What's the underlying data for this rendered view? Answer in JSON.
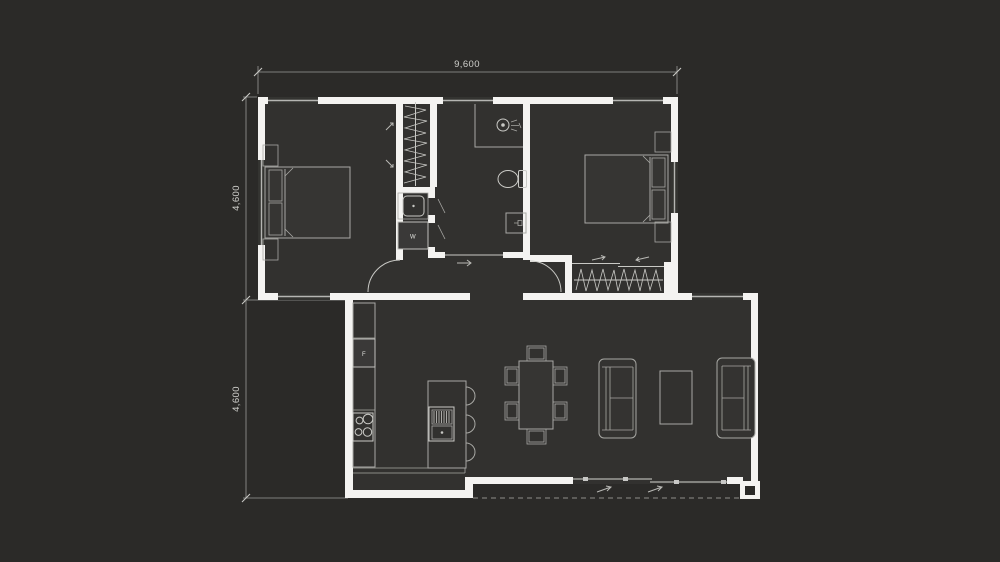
{
  "colors": {
    "background": "#2b2a28",
    "interior": "#32312f",
    "wall": "#f4f3f1",
    "line": "#a8a8a4",
    "line_bright": "#c9c9c5",
    "text": "#cfcfcb",
    "window": "#b5b5b2",
    "recess": "#343431",
    "dim": "#9a9a96",
    "dash": "#8f8e8a"
  },
  "dimensions": {
    "width": {
      "label": "9,600"
    },
    "height_upper": {
      "label": "4,600"
    },
    "height_lower": {
      "label": "4,600"
    }
  },
  "appliances": {
    "fridge_label": "F",
    "washer_label": "W"
  },
  "fixtures": {
    "bedroom_left": [
      "double-bed",
      "bedside-table",
      "bedside-table",
      "sliding-robe-arrows"
    ],
    "closet_left": [
      "hanging-clothes-rail"
    ],
    "laundry": [
      "laundry-tub",
      "washing-machine"
    ],
    "bathroom": [
      "shower",
      "shower-rose",
      "toilet",
      "vanity-basin",
      "sliding-door"
    ],
    "bedroom_right": [
      "double-bed",
      "bedside-table",
      "bedside-table",
      "wardrobe-hanging-clothes",
      "sliding-wardrobe-doors"
    ],
    "kitchen": [
      "fridge",
      "cooktop-4-burners",
      "bench-counter",
      "island-bench",
      "island-sink",
      "bar-stool",
      "bar-stool",
      "bar-stool"
    ],
    "dining": [
      "dining-table",
      "chair",
      "chair",
      "chair",
      "chair",
      "chair",
      "chair"
    ],
    "living": [
      "sofa",
      "sofa",
      "coffee-table",
      "sliding-glass-door",
      "deck-dashed-line"
    ]
  }
}
